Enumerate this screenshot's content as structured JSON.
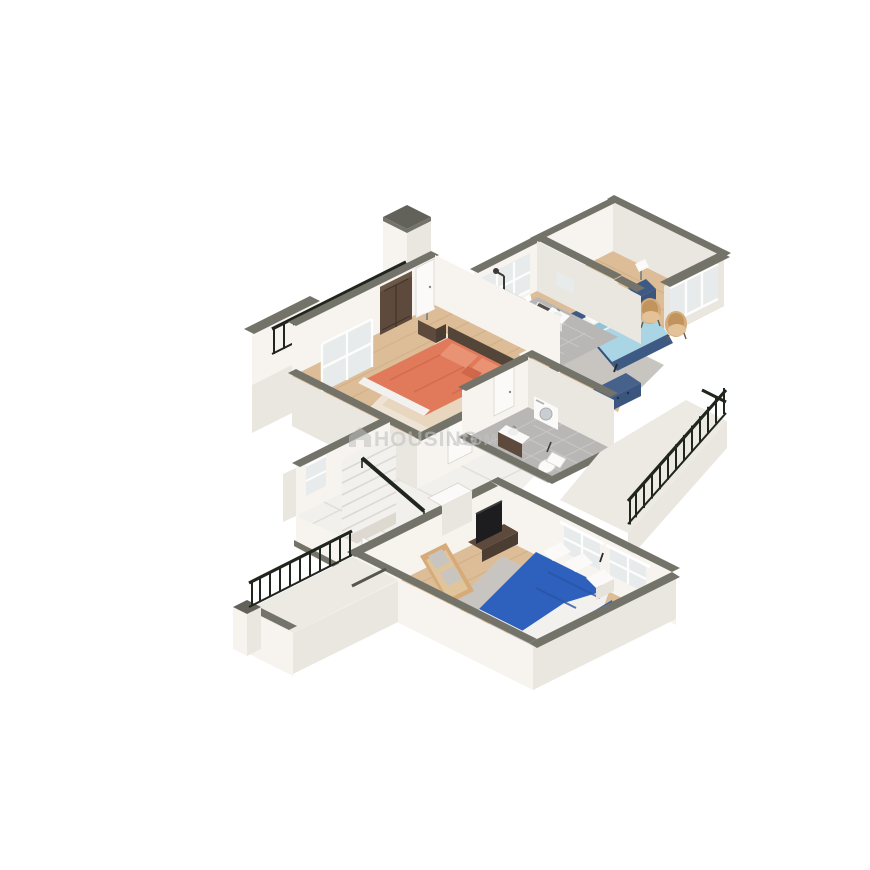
{
  "watermark": {
    "brand": "HOUSING",
    "suffix": ".COM",
    "logo": "house-icon"
  },
  "background": "#ffffff",
  "palette": {
    "bg": "#ffffff",
    "wall-light": "#f7f4ef",
    "wall-mid": "#eae7e0",
    "wall-dark": "#ddd9d1",
    "cap": "#73736a",
    "cap-dark": "#62625b",
    "balcony-floor": "#eceae3",
    "wood": "#dcbd97",
    "wood-line": "#c8a67c",
    "tile-white": "#f2f0ec",
    "tile-line": "#e1ded8",
    "tile-gray": "#b8b7b5",
    "tile-gray-line": "#c7c6c4",
    "marble": "#f3f1ed",
    "railing": "#20251d",
    "bed-orange": "#e07a5a",
    "bed-orange-dark": "#d0674a",
    "pillow-orange": "#ea9274",
    "headboard-wood": "#544539",
    "bed-blue-light": "#a9d5e5",
    "bed-navy": "#3d5a85",
    "bed-royal": "#2e61bd",
    "duvet-white": "#f2f1ed",
    "rug-gray": "#c8c5c1",
    "chair-tan": "#d6ab79",
    "chair-tan-dark": "#c1945e",
    "furniture-dark-wood": "#5d4a3c",
    "mirror-teal": "#3eb5c8",
    "fixture-white": "#fbfaf8",
    "glass": "#e7ebeb",
    "tv-black": "#1d1d1f",
    "watermark-gray": "#c0c0c0"
  },
  "scene": {
    "type": "isometric-3d-floor-plan",
    "rooms": [
      "top-balcony",
      "master-bedroom-orange",
      "attached-bathroom-top",
      "bedroom-blue",
      "common-bathroom-middle",
      "hall-with-stairs",
      "bedroom-bottom-blue",
      "bottom-left-balcony",
      "right-terrace"
    ],
    "furniture": [
      "orange-double-bed",
      "dark-wardrobe",
      "nightstands-with-lamps",
      "shower",
      "toilet",
      "vanity-sink",
      "blue-double-bed",
      "tan-accent-chairs",
      "teal-round-mirror",
      "navy-dresser",
      "washing-machine",
      "marble-staircase",
      "stair-handrail",
      "royal-blue-bed",
      "tv-unit",
      "beige-daybed",
      "poufs",
      "metal-railings"
    ]
  }
}
